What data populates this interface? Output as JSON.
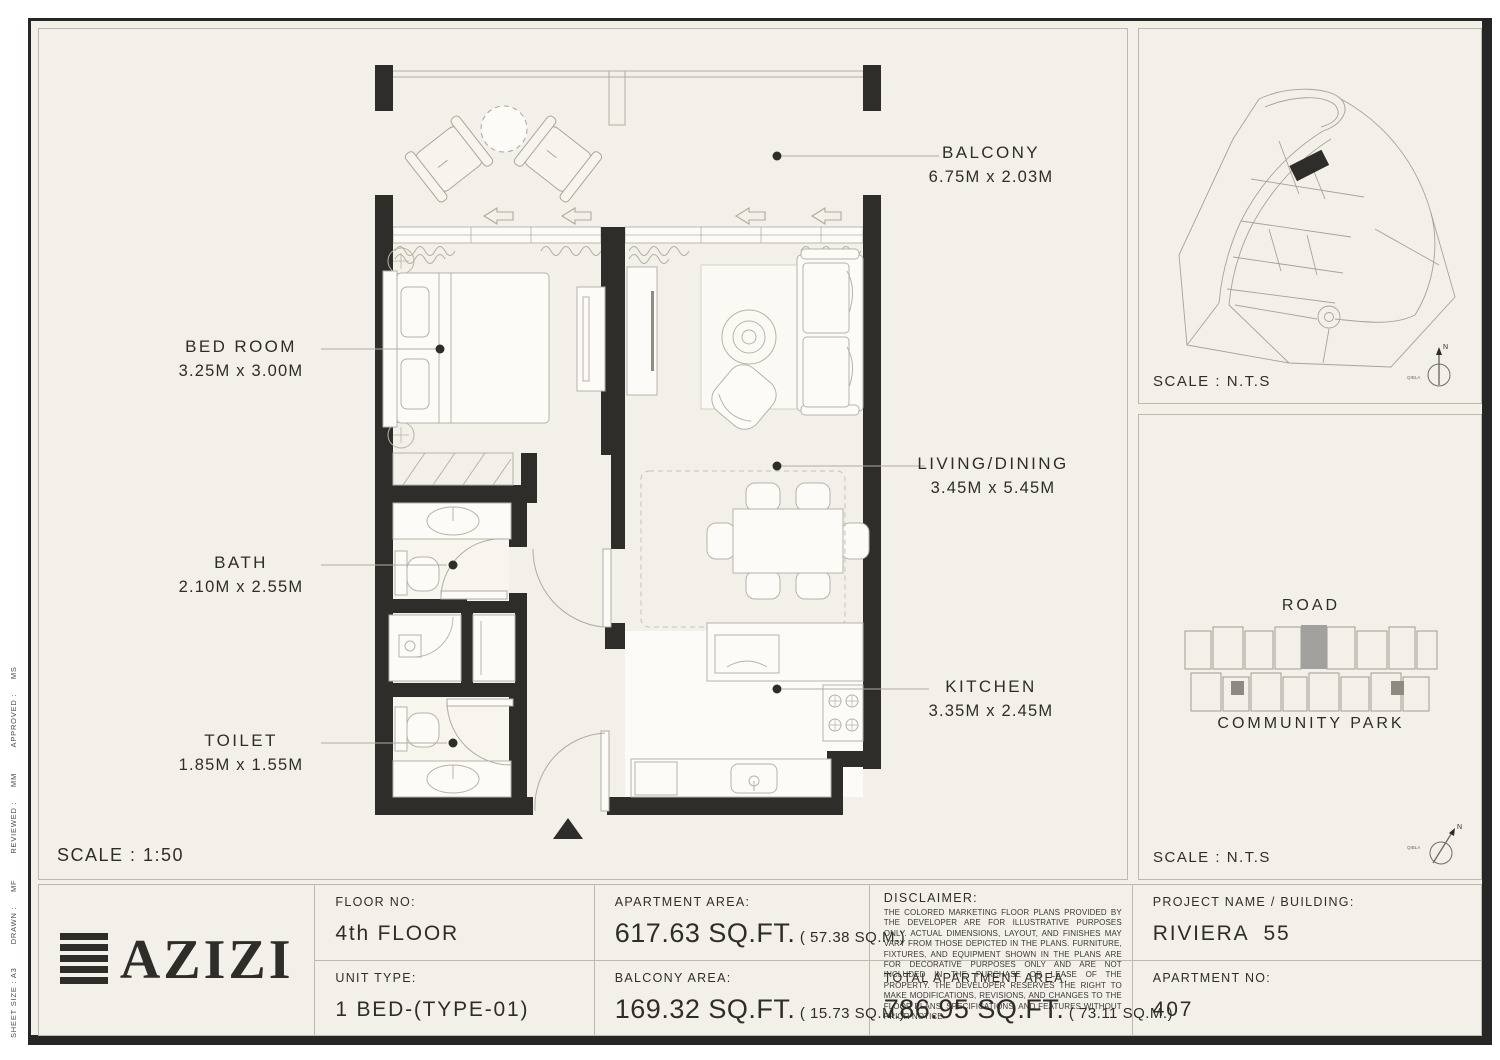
{
  "document": {
    "sheet_meta": "SHEET SIZE : A3        DRAWN :     MF         REVIEWED :     MM         APPROVED :     MS",
    "scale_main": "SCALE : 1:50"
  },
  "floor_plan": {
    "rooms": [
      {
        "label": "BALCONY",
        "dims": "6.75M x 2.03M"
      },
      {
        "label": "BED ROOM",
        "dims": "3.25M x 3.00M"
      },
      {
        "label": "LIVING/DINING",
        "dims": "3.45M x 5.45M"
      },
      {
        "label": "BATH",
        "dims": "2.10M x 2.55M"
      },
      {
        "label": "KITCHEN",
        "dims": "3.35M x 2.45M"
      },
      {
        "label": "TOILET",
        "dims": "1.85M x 1.55M"
      }
    ]
  },
  "site_panel": {
    "scale": "SCALE : N.T.S",
    "north": "N",
    "qibla": "QIBLA"
  },
  "location_panel": {
    "road": "ROAD",
    "park": "COMMUNITY PARK",
    "scale": "SCALE : N.T.S",
    "north": "N",
    "qibla": "QIBLA"
  },
  "title_block": {
    "logo": "AZIZI",
    "floor": {
      "label": "FLOOR NO:",
      "value": "4th FLOOR"
    },
    "unit": {
      "label": "UNIT TYPE:",
      "value": "1 BED-(TYPE-01)"
    },
    "apartment_area": {
      "label": "APARTMENT AREA:",
      "sqft": "617.63 SQ.FT.",
      "sqm": "( 57.38 SQ.M.)"
    },
    "balcony_area": {
      "label": "BALCONY AREA:",
      "sqft": "169.32 SQ.FT.",
      "sqm": "( 15.73 SQ.M.)"
    },
    "disclaimer": {
      "label": "DISCLAIMER:",
      "text": "THE COLORED MARKETING FLOOR PLANS PROVIDED BY THE DEVELOPER ARE FOR ILLUSTRATIVE PURPOSES ONLY. ACTUAL DIMENSIONS, LAYOUT, AND FINISHES MAY VARY FROM THOSE DEPICTED IN THE PLANS. FURNITURE, FIXTURES, AND EQUIPMENT SHOWN IN THE PLANS ARE FOR DECORATIVE PURPOSES ONLY AND ARE NOT INCLUDED IN THE PURCHASE OR LEASE OF THE PROPERTY. THE DEVELOPER RESERVES THE RIGHT TO MAKE MODIFICATIONS, REVISIONS, AND CHANGES TO THE FLOOR PLANS, SPECIFICATIONS, AND FEATURES WITHOUT PRIOR NOTICE."
    },
    "total_area": {
      "label": "TOTAL APARTMENT AREA:",
      "sqft": "786.95 SQ.FT.",
      "sqm": "( 73.11 SQ.M.)"
    },
    "project": {
      "label": "PROJECT NAME / BUILDING:",
      "value": "RIVIERA  55"
    },
    "apartment": {
      "label": "APARTMENT NO:",
      "value": "407"
    }
  },
  "colors": {
    "wall": "#2e2d2a",
    "paper": "#f2f0e9",
    "line": "#b3afa3",
    "highlight": "#a2a19d"
  }
}
